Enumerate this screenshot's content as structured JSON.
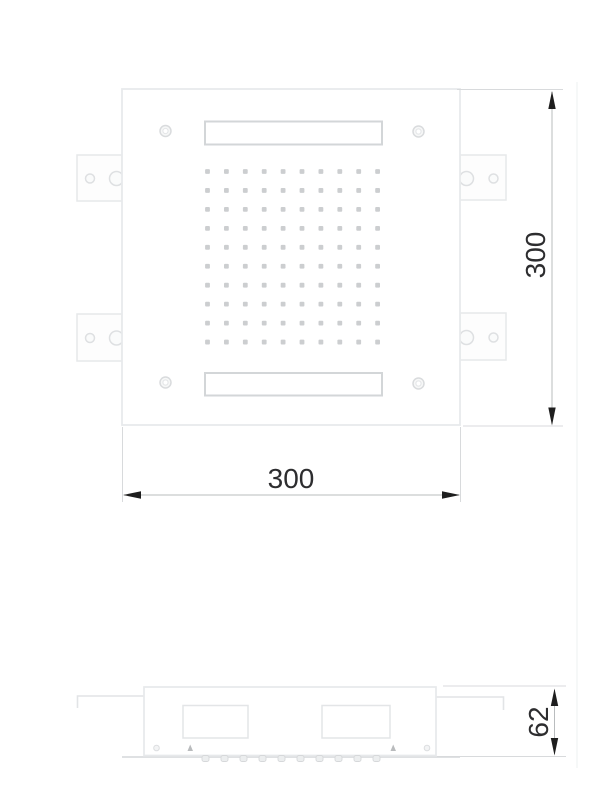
{
  "drawing": {
    "dim_width_label": "300",
    "dim_height_label": "300",
    "dim_depth_label": "62",
    "nozzle_grid": {
      "rows": 10,
      "cols": 10,
      "start_x": 207.5,
      "start_y": 171.5,
      "step_x": 18.9,
      "step_y": 18.95,
      "size": 4.8
    },
    "spray_bumps": {
      "count": 10,
      "start_x": 205.5,
      "step": 19.0,
      "y": 755.5,
      "width": 7,
      "height": 6
    },
    "colors": {
      "background": "#ffffff",
      "panel_outline": "#e8eaec",
      "detail_outline": "#dcdee0",
      "slot_outline": "#d3d6d8",
      "nozzle_dot": "#c7c9cb",
      "extension_line": "#d8dadc",
      "dimension_line": "#b9bcbe",
      "arrow": "#1e1e1e",
      "dimension_text": "#2d2d2f"
    }
  }
}
